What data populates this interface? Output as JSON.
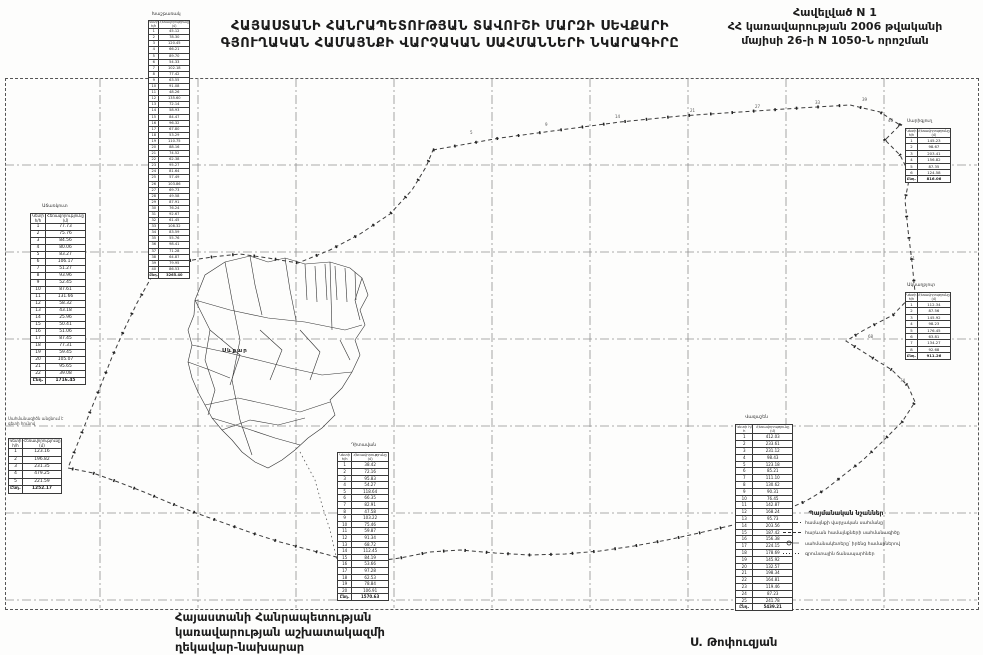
{
  "header": {
    "title_line1": "ՀԱՅԱՍՏԱՆԻ ՀԱՆՐԱՊԵՏՈՒԹՅԱՆ ՏԱՎՈՒՇԻ ՄԱՐԶԻ ՍԵՎՔԱՐԻ",
    "title_line2": "ԳՅՈՒՂԱԿԱՆ ՀԱՄԱՅՆՔԻ ՎԱՐՉԱԿԱՆ ՍԱՀՄԱՆՆԵՐԻ ՆԿԱՐԱԳԻՐԸ",
    "appendix_line1": "Հավելված N 1",
    "appendix_line2": "ՀՀ կառավարության 2006 թվականի",
    "appendix_line3": "մայիսի 26-ի N 1050-Ն որոշման"
  },
  "footer": {
    "sig_line1": "Հայաստանի Հանրապետության",
    "sig_line2": "կառավարության աշխատակազմի",
    "sig_line3": "ղեկավար-նախարար",
    "signer": "Ս. Թոփուզյան"
  },
  "map": {
    "village_label": "Սևքար",
    "note_line1": "Սահմանագիծն անցնում է",
    "note_line2": "գետի հունով"
  },
  "legend": {
    "title": "Պայմանական նշաններ",
    "items": [
      {
        "symbol": "dashdot-line",
        "label": "համայնքի վարչական սահմանը"
      },
      {
        "symbol": "dashed-line",
        "label": "հարևան համայնքների սահմանագիծը"
      },
      {
        "symbol": "border-point",
        "label": "սահմանակետերը՝ իրենց համարներով"
      },
      {
        "symbol": "dotted-line",
        "label": "գրունտային ճանապարհներ"
      }
    ]
  },
  "point_numbers": [
    "5",
    "9",
    "14",
    "21",
    "27",
    "33",
    "39",
    "46",
    "53",
    "61",
    "68",
    "74"
  ],
  "tables": {
    "t1": {
      "label": "Խաշթառակ",
      "col1": "Կետի հ/հ",
      "col2": "Հեռավորությունը (մ)",
      "rows": [
        [
          "1",
          "45.12"
        ],
        [
          "2",
          "78.30"
        ],
        [
          "3",
          "120.45"
        ],
        [
          "4",
          "66.21"
        ],
        [
          "5",
          "89.70"
        ],
        [
          "6",
          "54.33"
        ],
        [
          "7",
          "102.18"
        ],
        [
          "8",
          "77.42"
        ],
        [
          "9",
          "63.55"
        ],
        [
          "10",
          "91.08"
        ],
        [
          "11",
          "48.26"
        ],
        [
          "12",
          "135.60"
        ],
        [
          "13",
          "72.14"
        ],
        [
          "14",
          "58.93"
        ],
        [
          "15",
          "84.47"
        ],
        [
          "16",
          "96.32"
        ],
        [
          "17",
          "67.80"
        ],
        [
          "18",
          "53.29"
        ],
        [
          "19",
          "110.75"
        ],
        [
          "20",
          "88.16"
        ],
        [
          "21",
          "74.52"
        ],
        [
          "22",
          "62.38"
        ],
        [
          "23",
          "95.27"
        ],
        [
          "24",
          "81.64"
        ],
        [
          "25",
          "57.49"
        ],
        [
          "26",
          "103.86"
        ],
        [
          "27",
          "69.73"
        ],
        [
          "28",
          "49.58"
        ],
        [
          "29",
          "87.91"
        ],
        [
          "30",
          "76.24"
        ],
        [
          "31",
          "92.67"
        ],
        [
          "32",
          "61.45"
        ],
        [
          "33",
          "108.32"
        ],
        [
          "34",
          "83.59"
        ],
        [
          "35",
          "55.76"
        ],
        [
          "36",
          "98.41"
        ],
        [
          "37",
          "71.28"
        ],
        [
          "38",
          "64.87"
        ],
        [
          "39",
          "79.95"
        ],
        [
          "40",
          "86.53"
        ]
      ],
      "total_label": "Ընդ.",
      "total_value": "3265.40"
    },
    "t2": {
      "label": "Աճառկուտ",
      "col1": "Կետի հ/հ",
      "col2": "Հեռավորությունը (մ)",
      "rows": [
        [
          "1",
          "77.73"
        ],
        [
          "2",
          "75.76"
        ],
        [
          "3",
          "84.56"
        ],
        [
          "4",
          "80.06"
        ],
        [
          "5",
          "83.27"
        ],
        [
          "6",
          "106.17"
        ],
        [
          "7",
          "51.27"
        ],
        [
          "8",
          "93.96"
        ],
        [
          "9",
          "52.45"
        ],
        [
          "10",
          "87.61"
        ],
        [
          "11",
          "131.66"
        ],
        [
          "12",
          "58.32"
        ],
        [
          "13",
          "43.18"
        ],
        [
          "14",
          "25.96"
        ],
        [
          "15",
          "50.41"
        ],
        [
          "16",
          "51.06"
        ],
        [
          "17",
          "87.45"
        ],
        [
          "18",
          "77.31"
        ],
        [
          "19",
          "59.45"
        ],
        [
          "20",
          "105.07"
        ],
        [
          "21",
          "95.65"
        ],
        [
          "22",
          "39.08"
        ]
      ],
      "total_label": "Ընդ.",
      "total_value": "1716.45"
    },
    "t3": {
      "label": "",
      "col1": "Կետի հ/հ",
      "col2": "Հեռավորությունը (մ)",
      "rows": [
        [
          "1",
          "123.16"
        ],
        [
          "2",
          "196.82"
        ],
        [
          "3",
          "231.35"
        ],
        [
          "4",
          "479.25"
        ],
        [
          "5",
          "221.59"
        ]
      ],
      "total_label": "Ընդ.",
      "total_value": "1252.17"
    },
    "t4": {
      "label": "Դիտավան",
      "col1": "Կետի հ/հ",
      "col2": "Հեռավորությունը (մ)",
      "rows": [
        [
          "1",
          "38.42"
        ],
        [
          "2",
          "72.16"
        ],
        [
          "3",
          "95.83"
        ],
        [
          "4",
          "54.27"
        ],
        [
          "5",
          "118.64"
        ],
        [
          "6",
          "66.35"
        ],
        [
          "7",
          "82.91"
        ],
        [
          "8",
          "47.58"
        ],
        [
          "9",
          "103.22"
        ],
        [
          "10",
          "75.46"
        ],
        [
          "11",
          "59.87"
        ],
        [
          "12",
          "91.34"
        ],
        [
          "13",
          "68.72"
        ],
        [
          "14",
          "112.45"
        ],
        [
          "15",
          "84.19"
        ],
        [
          "16",
          "53.66"
        ],
        [
          "17",
          "97.28"
        ],
        [
          "18",
          "62.53"
        ],
        [
          "19",
          "78.84"
        ],
        [
          "20",
          "106.91"
        ]
      ],
      "total_label": "Ընդ.",
      "total_value": "1570.63"
    },
    "t5": {
      "label": "Վազաշեն",
      "col1": "Կետի հ/հ",
      "col2": "Հեռավորությունը (մ)",
      "rows": [
        [
          "1",
          "412.03"
        ],
        [
          "2",
          "233.61"
        ],
        [
          "3",
          "231.12"
        ],
        [
          "4",
          "98.43"
        ],
        [
          "5",
          "123.18"
        ],
        [
          "6",
          "85.21"
        ],
        [
          "7",
          "111.10"
        ],
        [
          "8",
          "130.62"
        ],
        [
          "9",
          "90.31"
        ],
        [
          "10",
          "76.45"
        ],
        [
          "11",
          "142.87"
        ],
        [
          "12",
          "168.24"
        ],
        [
          "13",
          "95.73"
        ],
        [
          "14",
          "203.56"
        ],
        [
          "15",
          "187.42"
        ],
        [
          "16",
          "156.38"
        ],
        [
          "17",
          "224.15"
        ],
        [
          "18",
          "178.69"
        ],
        [
          "19",
          "145.92"
        ],
        [
          "20",
          "132.57"
        ],
        [
          "21",
          "198.34"
        ],
        [
          "22",
          "164.81"
        ],
        [
          "23",
          "119.46"
        ],
        [
          "24",
          "87.23"
        ],
        [
          "25",
          "241.78"
        ]
      ],
      "total_label": "Ընդ.",
      "total_value": "5439.21"
    },
    "t6": {
      "label": "Սարիգյուղ",
      "col1": "Կետի հ/հ",
      "col2": "Հեռավորությունը (մ)",
      "rows": [
        [
          "1",
          "145.23"
        ],
        [
          "2",
          "98.67"
        ],
        [
          "3",
          "203.41"
        ],
        [
          "4",
          "156.82"
        ],
        [
          "5",
          "87.35"
        ],
        [
          "6",
          "124.58"
        ]
      ],
      "total_label": "Ընդ.",
      "total_value": "816.06"
    },
    "t7": {
      "label": "Ակնաղբյուր",
      "col1": "Կետի հ/հ",
      "col2": "Հեռավորությունը (մ)",
      "rows": [
        [
          "1",
          "112.34"
        ],
        [
          "2",
          "87.56"
        ],
        [
          "3",
          "145.92"
        ],
        [
          "4",
          "98.23"
        ],
        [
          "5",
          "176.45"
        ],
        [
          "6",
          "63.81"
        ],
        [
          "7",
          "134.27"
        ],
        [
          "8",
          "92.68"
        ]
      ],
      "total_label": "Ընդ.",
      "total_value": "911.26"
    }
  }
}
